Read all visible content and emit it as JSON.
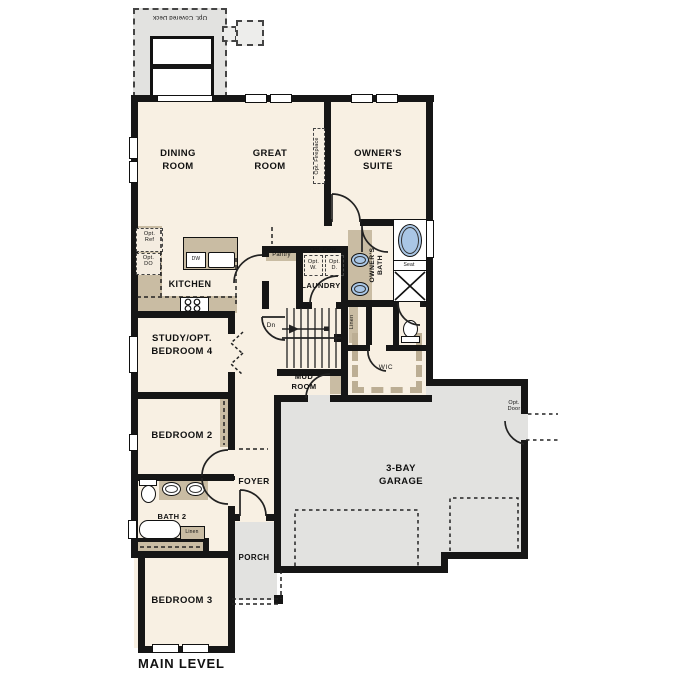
{
  "title": "MAIN LEVEL",
  "colors": {
    "floor": "#f8f0e3",
    "wall": "#161616",
    "exterior_gray": "#e2e2e0",
    "cabinet_tan": "#c9bca3",
    "fixture_blue": "#a9c6e5",
    "background": "#ffffff"
  },
  "rooms": {
    "deck": "Opt. Covered Deck",
    "dining": [
      "DINING",
      "ROOM"
    ],
    "great": [
      "GREAT",
      "ROOM"
    ],
    "suite": [
      "OWNER'S",
      "SUITE"
    ],
    "kitchen": "KITCHEN",
    "pantry": "Pantry",
    "laundry": "LAUNDRY",
    "owners_bath": [
      "OWNER'S",
      "BATH"
    ],
    "study": [
      "STUDY/OPT.",
      "BEDROOM 4"
    ],
    "mud_room": [
      "MUD",
      "ROOM"
    ],
    "wic": "WIC",
    "bedroom2": "BEDROOM 2",
    "foyer": "FOYER",
    "bath2": "BATH 2",
    "bedroom3": "BEDROOM 3",
    "porch": "PORCH",
    "garage": [
      "3-BAY",
      "GARAGE"
    ]
  },
  "annotations": {
    "opt_fireplace": "Opt. Fireplace",
    "opt_ref": [
      "Opt.",
      "Ref"
    ],
    "opt_do": [
      "Opt.",
      "DO"
    ],
    "opt_cabs": "Opt. Cabs",
    "opt_w": [
      "Opt.",
      "W."
    ],
    "opt_d": [
      "Opt.",
      "D."
    ],
    "opt_door": [
      "Opt.",
      "Door"
    ],
    "seat": "Seat",
    "linen_owner": "Linen",
    "linen_bath2": "Linen",
    "dn": "Dn",
    "dw": "DW"
  },
  "fixtures": [
    "kitchen-sink",
    "dishwasher",
    "range",
    "kitchen-island",
    "owner-tub",
    "owner-shower",
    "owner-toilet",
    "owner-double-vanity",
    "bath2-toilet",
    "bath2-double-vanity",
    "bath2-tub",
    "stairs-down",
    "washer-dryer-optional"
  ]
}
